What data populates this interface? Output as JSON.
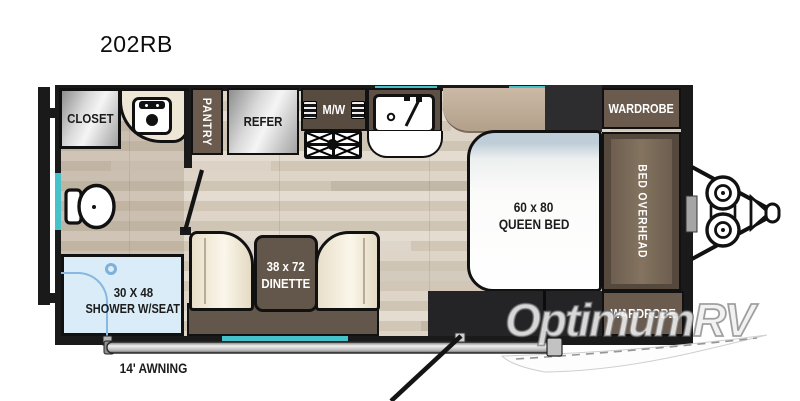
{
  "title": "202RB",
  "watermark": "OptimumRV",
  "labels": {
    "closet": "CLOSET",
    "pantry": "PANTRY",
    "refrigerator": "REFER",
    "microwave": "M/W",
    "shower_size": "30 X 48",
    "shower": "SHOWER W/SEAT",
    "dinette_size": "38 x 72",
    "dinette": "DINETTE",
    "bed_size": "60 x 80",
    "bed": "QUEEN BED",
    "bed_overhead": "BED OVERHEAD",
    "wardrobe_front": "WARDROBE",
    "wardrobe_rear": "WARDROBE",
    "awning": "14' AWNING"
  },
  "colors": {
    "window_accent": "#45c2ca",
    "cabinet_brown": "#6a5b4e",
    "wall_black": "#1a1a1a",
    "shower_blue": "#d9ecf7",
    "floor_tan": "#d9cfc2",
    "charcoal": "#2d2d2f"
  }
}
